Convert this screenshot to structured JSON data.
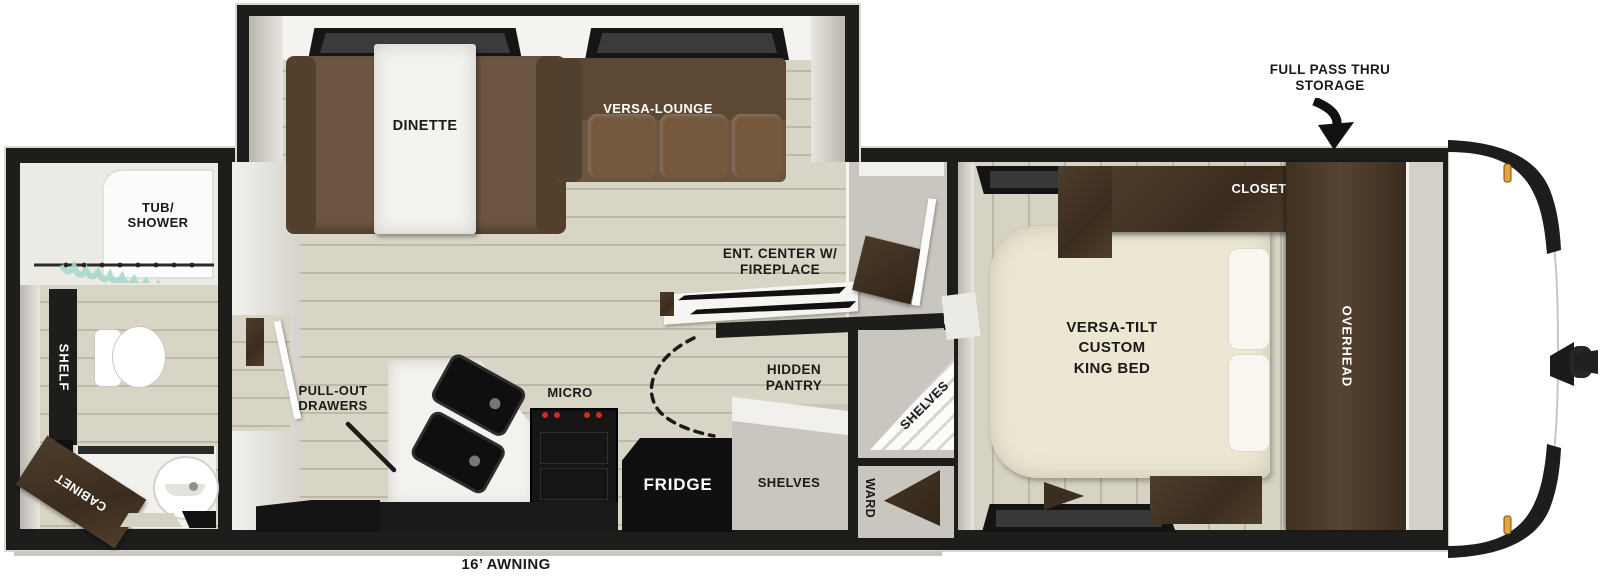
{
  "diagram": {
    "type": "travel-trailer floorplan, top-down",
    "colors": {
      "wall": "#1d1d1b",
      "floor_wood": "#d9d5c6",
      "interior_gray": "#c9c6bf",
      "sofa_brown": "#6b5440",
      "cabinet_dark_brown": "#42332a",
      "bed_cream": "#ebe7d3",
      "marker_light_amber": "#e8a33d",
      "shower_curtain_teal": "#a9d9cb",
      "burner_red": "#cf2b20"
    },
    "labels": {
      "pass_thru": "FULL PASS THRU\nSTORAGE",
      "awning": "16’ AWNING",
      "tub_shower": "TUB/\nSHOWER",
      "shelf": "SHELF",
      "cabinet": "CABINET",
      "dinette": "DINETTE",
      "versa_lounge": "VERSA-LOUNGE",
      "pull_out_drawers": "PULL-OUT\nDRAWERS",
      "micro": "MICRO",
      "fridge": "FRIDGE",
      "ent_center": "ENT. CENTER W/\nFIREPLACE",
      "hidden_pantry": "HIDDEN\nPANTRY",
      "pantry_shelves": "SHELVES",
      "lower_shelves": "SHELVES",
      "ward": "WARD",
      "closet": "CLOSET",
      "overhead": "OVERHEAD",
      "king_bed": "VERSA-TILT\nCUSTOM\nKING BED"
    }
  }
}
